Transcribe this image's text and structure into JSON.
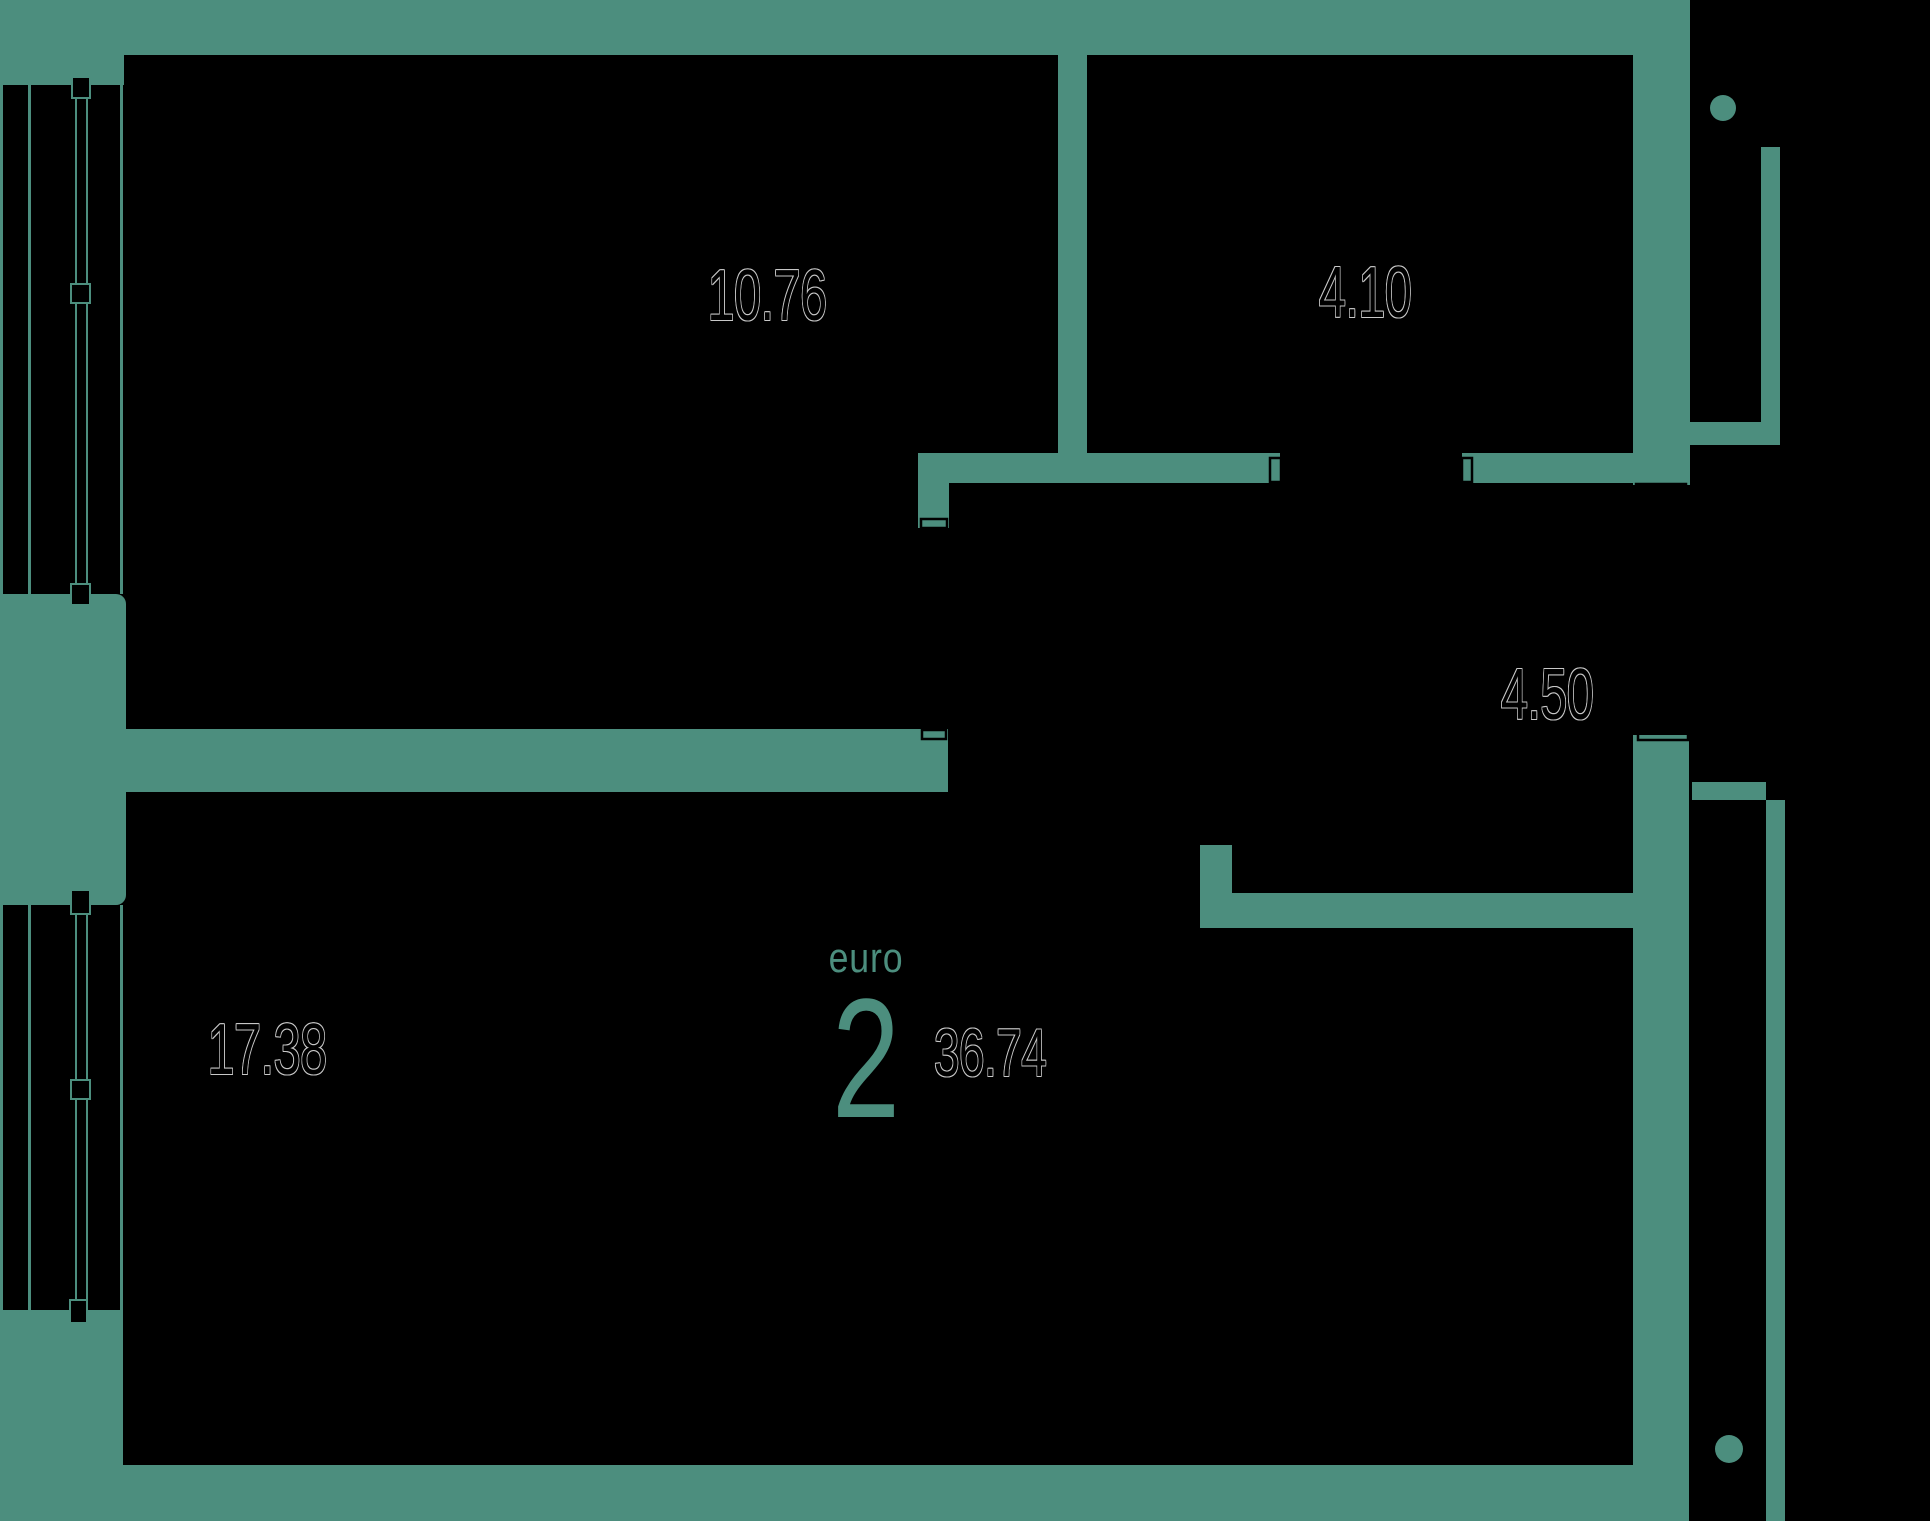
{
  "floorplan": {
    "background_color": "#000000",
    "wall_color": "#4c8e7e",
    "label_outline_color": "#c8c8c8",
    "rooms": [
      {
        "area": "10.76"
      },
      {
        "area": "4.10"
      },
      {
        "area": "4.50"
      },
      {
        "area": "17.38"
      }
    ],
    "apartment": {
      "layout_type_label": "euro",
      "room_count": "2",
      "total_area": "36.74"
    }
  }
}
